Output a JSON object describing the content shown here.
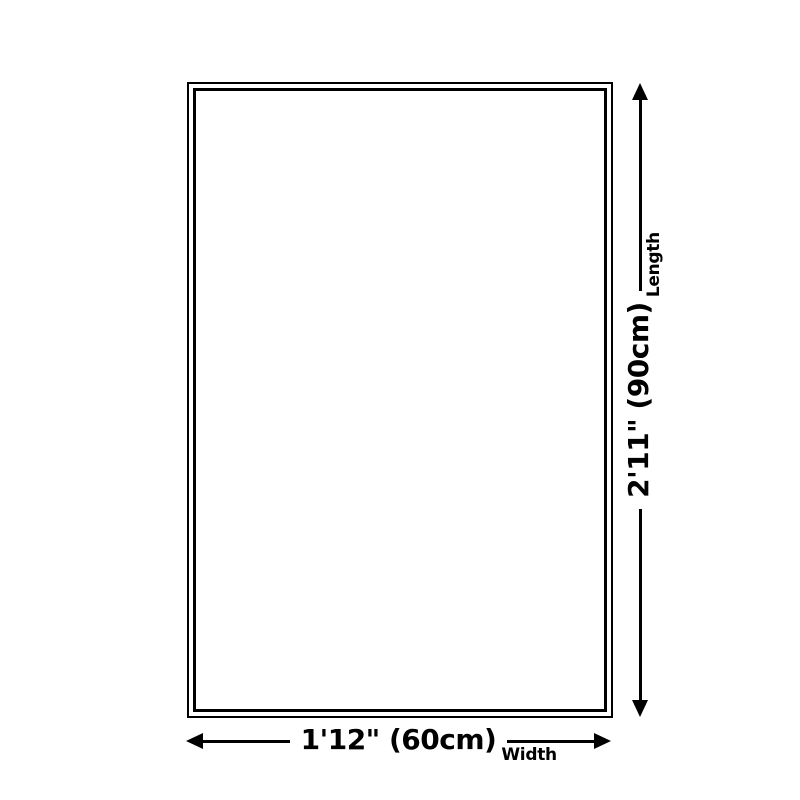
{
  "diagram": {
    "type": "product-dimension-diagram",
    "width_annotation": {
      "value": "1'12\" (60cm)",
      "label": "Width"
    },
    "length_annotation": {
      "value": "2'11\" (90cm)",
      "label": "Length"
    }
  },
  "colors": {
    "line": "#000000",
    "background": "#ffffff"
  }
}
